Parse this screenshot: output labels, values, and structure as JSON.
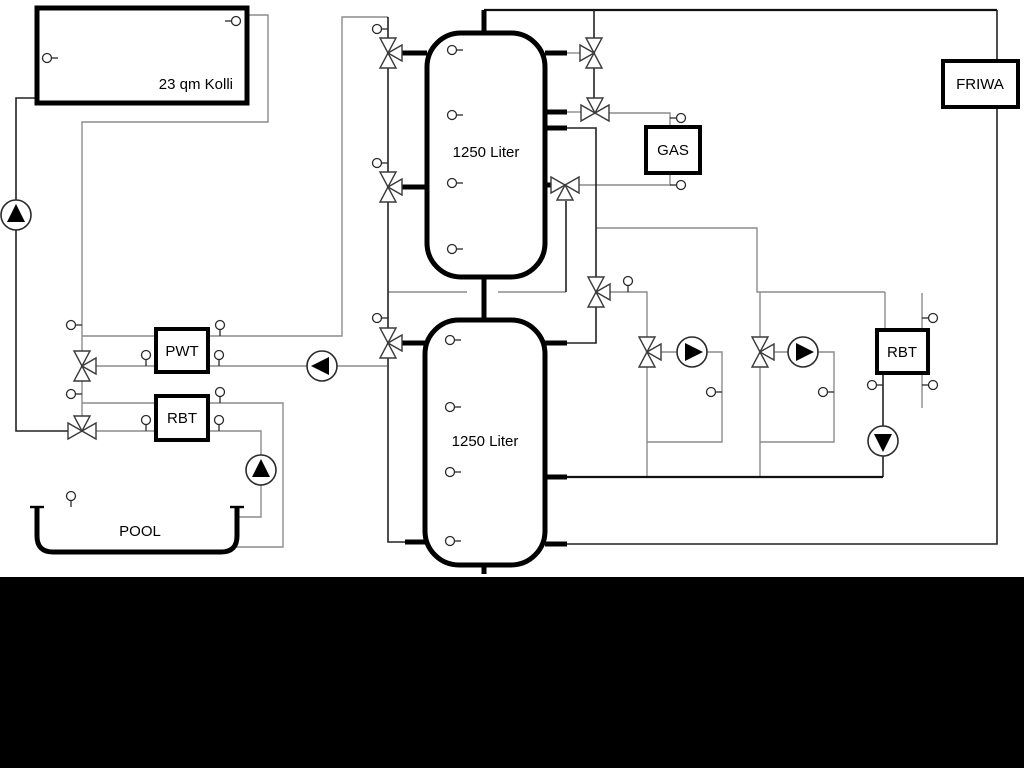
{
  "labels": {
    "collector": "23 qm Kolli",
    "buffer_tank_top": "1250 Liter",
    "buffer_tank_bottom": "1250 Liter",
    "gas_boiler": "GAS",
    "fresh_water_station": "FRIWA",
    "pwt_heat_exchanger": "PWT",
    "rbt_heat_exchanger_left": "RBT",
    "rbt_heat_exchanger_right": "RBT",
    "pool": "POOL"
  },
  "colors": {
    "background": "#ffffff",
    "footer_band": "#000000",
    "outline": "#000000",
    "pipe_dark": "#222222",
    "pipe_gray": "#8c8c8c"
  },
  "equipment": {
    "pumps": [
      {
        "name": "solar-pump",
        "direction": "up"
      },
      {
        "name": "pwt-charge-pump",
        "direction": "left"
      },
      {
        "name": "heating-circuit-1-pump",
        "direction": "right"
      },
      {
        "name": "heating-circuit-2-pump",
        "direction": "right"
      },
      {
        "name": "rbt-circuit-pump",
        "direction": "down"
      },
      {
        "name": "pool-pump",
        "direction": "up"
      }
    ],
    "valve_count": 11,
    "sensor_count": 30
  }
}
